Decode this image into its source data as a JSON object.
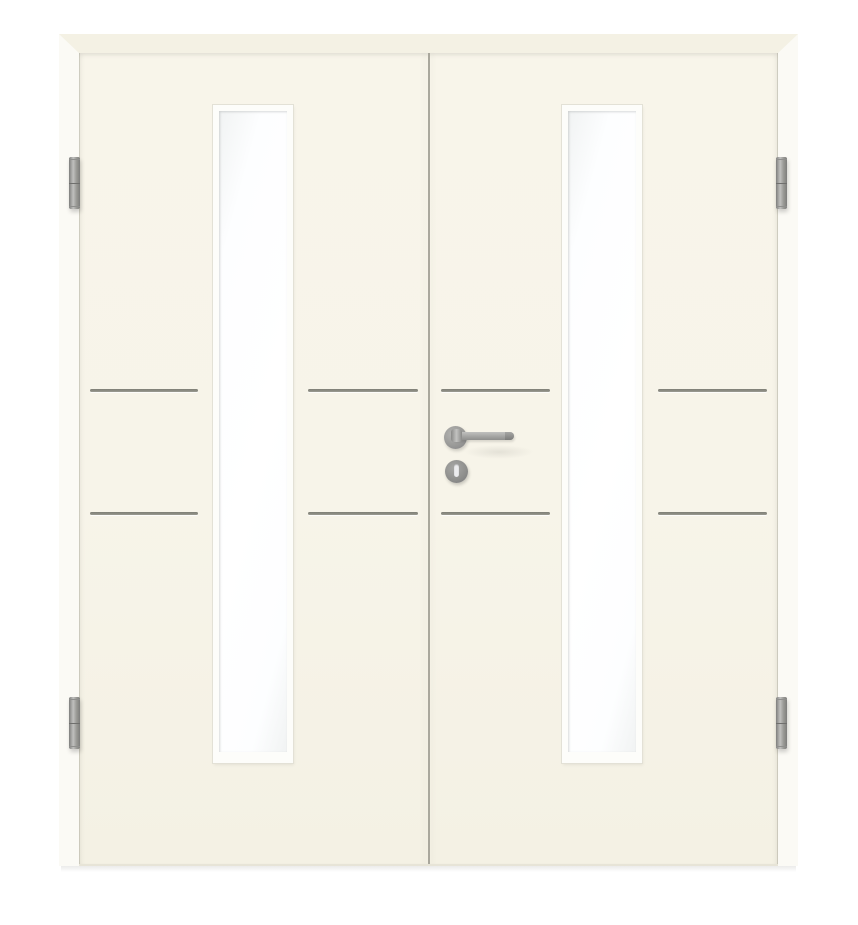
{
  "meta": {
    "type": "product-photo",
    "subject": "Cream-white interior double door with narrow vertical glass lites",
    "description": "Two-leaf smooth lacquered door in a matching frame. Each leaf has one tall narrow glass cutout with white glazing bead and frosted glass, plus two pairs of horizontal stainless-steel inlay grooves. The right (active) leaf carries a stainless lever handle on a round rose with a keyhole escutcheon below. Each leaf hangs on two silver barrel hinges."
  },
  "colors": {
    "page_bg": "#ffffff",
    "door_face": "#f7f4e9",
    "frame_top": "#f4f1e4",
    "frame_side": "#fbfaf5",
    "glass": "#fdfeff",
    "bead": "#fdfdfa",
    "groove": "#8b8b82",
    "gap_line": "#a9a79c",
    "steel_light": "#c0c0be",
    "steel_mid": "#9a9a98",
    "steel_dark": "#77777a",
    "keyhole_slot": "#ececee"
  },
  "objects": {
    "frame": "door frame casing",
    "left_leaf": "left door leaf",
    "right_leaf": "right door leaf (active, with handle)",
    "left_glass": "left vertical glass lite",
    "right_glass": "right vertical glass lite",
    "grooves": "four pairs of horizontal stainless inlay grooves",
    "handle": "stainless lever handle on round rose",
    "escutcheon": "round keyhole escutcheon",
    "hinges": [
      "top-left hinge",
      "bottom-left hinge",
      "top-right hinge",
      "bottom-right hinge"
    ]
  }
}
